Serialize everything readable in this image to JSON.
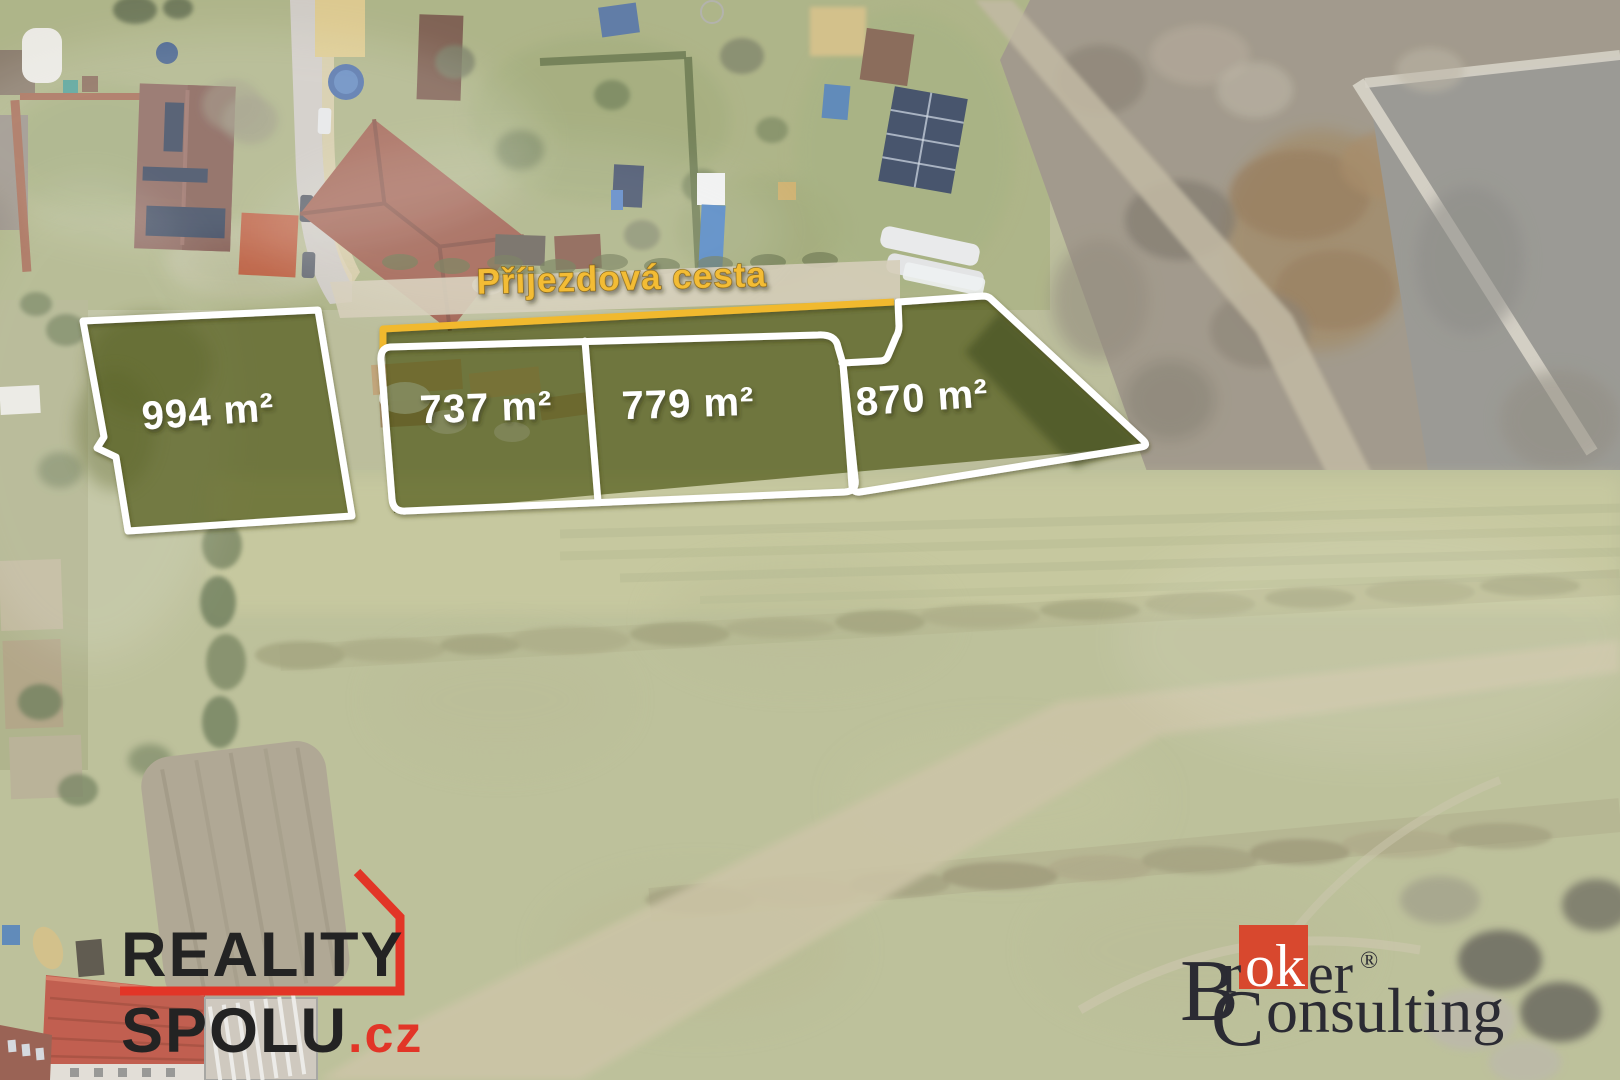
{
  "scene": {
    "road_label": "Příjezdová cesta",
    "parcels": [
      {
        "id": "parcel-1",
        "area_label": "994 m²"
      },
      {
        "id": "parcel-2",
        "area_label": "737 m²"
      },
      {
        "id": "parcel-3",
        "area_label": "779 m²"
      },
      {
        "id": "parcel-4",
        "area_label": "870 m²"
      }
    ]
  },
  "branding": {
    "reality_spolu": {
      "line1": "REALITY",
      "line2": "SPOLU",
      "tld": ".cz"
    },
    "broker_consulting": {
      "prefix_cap": "B",
      "prefix_rest": "r",
      "highlight": "ok",
      "suffix": "er",
      "registered": "®",
      "line2_cap": "C",
      "line2_rest": "onsulting"
    }
  },
  "colors": {
    "parcel_overlay": "rgba(60,70,0,0.60)",
    "outline_white": "#ffffff",
    "access_road_orange": "#f1b92e",
    "road_label_fill": "#f3bc35",
    "reality_black": "#232323",
    "reality_red": "#e23527",
    "broker_dark": "#2b2b33",
    "broker_red": "#d8482e"
  }
}
